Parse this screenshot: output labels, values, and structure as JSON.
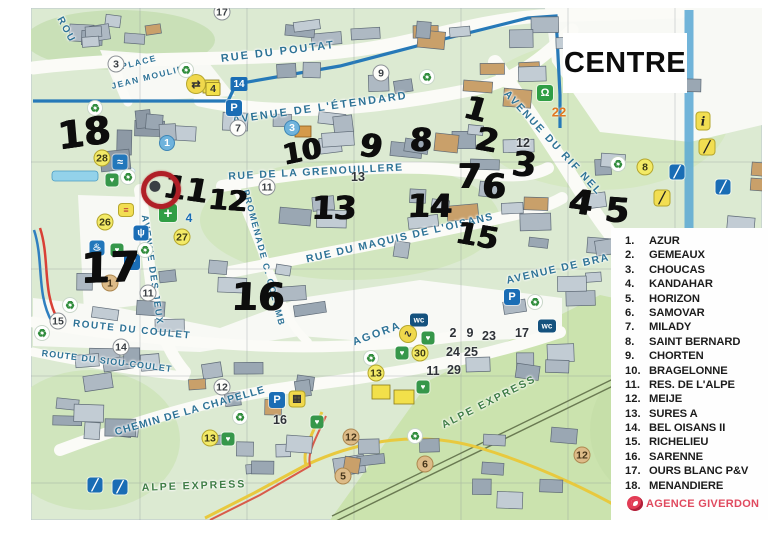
{
  "title": "CENTRE",
  "legend": {
    "agency": "AGENCE GIVERDON",
    "items": [
      {
        "num": "1.",
        "name": "AZUR"
      },
      {
        "num": "2.",
        "name": "GEMEAUX"
      },
      {
        "num": "3.",
        "name": "CHOUCAS"
      },
      {
        "num": "4.",
        "name": "KANDAHAR"
      },
      {
        "num": "5.",
        "name": "HORIZON"
      },
      {
        "num": "6.",
        "name": "SAMOVAR"
      },
      {
        "num": "7.",
        "name": "MILADY"
      },
      {
        "num": "8.",
        "name": "SAINT BERNARD"
      },
      {
        "num": "9.",
        "name": "CHORTEN"
      },
      {
        "num": "10.",
        "name": "BRAGELONNE"
      },
      {
        "num": "11.",
        "name": "RES. DE L'ALPE"
      },
      {
        "num": "12.",
        "name": "MEIJE"
      },
      {
        "num": "13.",
        "name": "SURES A"
      },
      {
        "num": "14.",
        "name": "BEL OISANS II"
      },
      {
        "num": "15.",
        "name": "RICHELIEU"
      },
      {
        "num": "16.",
        "name": "SARENNE"
      },
      {
        "num": "17.",
        "name": "OURS BLANC P&V"
      },
      {
        "num": "18.",
        "name": "MENANDIERE"
      }
    ]
  },
  "streets": [
    {
      "name": "ROU",
      "x": 66,
      "y": 30,
      "rot": 62,
      "size": 10,
      "ls": 2,
      "color": "teal"
    },
    {
      "name": "PLACE",
      "x": 139,
      "y": 62,
      "rot": -14,
      "size": 8.5,
      "ls": 1.5,
      "color": "teal"
    },
    {
      "name": "JEAN MOULIN",
      "x": 148,
      "y": 77,
      "rot": -14,
      "size": 8.5,
      "ls": 1.5,
      "color": "teal"
    },
    {
      "name": "RUE DU POUTAT",
      "x": 278,
      "y": 52,
      "rot": -7,
      "size": 11,
      "ls": 2,
      "color": "teal"
    },
    {
      "name": "AVENUE DE L'ÉTENDARD",
      "x": 320,
      "y": 108,
      "rot": -8,
      "size": 11,
      "ls": 2,
      "color": "teal"
    },
    {
      "name": "RUE DE LA GRENOUILLERE",
      "x": 316,
      "y": 172,
      "rot": -3,
      "size": 10.5,
      "ls": 1.5,
      "color": "teal"
    },
    {
      "name": "PROMENADE C. COLOMB",
      "x": 264,
      "y": 258,
      "rot": 75,
      "size": 9,
      "ls": 1.5,
      "color": "teal"
    },
    {
      "name": "RUE DU MAQUIS DE L'OISANS",
      "x": 400,
      "y": 238,
      "rot": -13,
      "size": 10.5,
      "ls": 1.5,
      "color": "teal"
    },
    {
      "name": "AVENUE DU RIF NEL",
      "x": 553,
      "y": 143,
      "rot": 47,
      "size": 10.5,
      "ls": 2,
      "color": "teal"
    },
    {
      "name": "AVENUE DE BRA",
      "x": 558,
      "y": 269,
      "rot": -13,
      "size": 10.5,
      "ls": 1.5,
      "color": "teal"
    },
    {
      "name": "AVENUE DES JEUX",
      "x": 152,
      "y": 270,
      "rot": 82,
      "size": 9.5,
      "ls": 1.5,
      "color": "teal"
    },
    {
      "name": "AGORA",
      "x": 377,
      "y": 334,
      "rot": -20,
      "size": 11,
      "ls": 2,
      "color": "teal"
    },
    {
      "name": "ROUTE DU COULET",
      "x": 132,
      "y": 330,
      "rot": 6,
      "size": 10,
      "ls": 1.5,
      "color": "teal"
    },
    {
      "name": "ROUTE DU SIOU-COULET",
      "x": 107,
      "y": 361,
      "rot": 7,
      "size": 9,
      "ls": 1,
      "color": "teal"
    },
    {
      "name": "CHEMIN DE LA CHAPELLE",
      "x": 190,
      "y": 411,
      "rot": -16,
      "size": 10.5,
      "ls": 1,
      "color": "teal"
    },
    {
      "name": "ALPE EXPRESS",
      "x": 489,
      "y": 402,
      "rot": -27,
      "size": 10.5,
      "ls": 2,
      "color": "green"
    },
    {
      "name": "ALPE EXPRESS",
      "x": 194,
      "y": 486,
      "rot": -2,
      "size": 10.5,
      "ls": 2,
      "color": "green"
    }
  ],
  "handwritten": [
    {
      "t": "18",
      "x": 84,
      "y": 133,
      "s": 38,
      "r": -8
    },
    {
      "t": "11",
      "x": 186,
      "y": 189,
      "s": 32,
      "r": 8
    },
    {
      "t": "12",
      "x": 228,
      "y": 201,
      "s": 28,
      "r": 4
    },
    {
      "t": "17",
      "x": 110,
      "y": 268,
      "s": 42,
      "r": -2
    },
    {
      "t": "16",
      "x": 258,
      "y": 297,
      "s": 38,
      "r": 0
    },
    {
      "t": "10",
      "x": 302,
      "y": 152,
      "s": 28,
      "r": -12
    },
    {
      "t": "9",
      "x": 371,
      "y": 146,
      "s": 32,
      "r": 8
    },
    {
      "t": "8",
      "x": 421,
      "y": 140,
      "s": 32,
      "r": 0
    },
    {
      "t": "13",
      "x": 334,
      "y": 208,
      "s": 32,
      "r": 0
    },
    {
      "t": "14",
      "x": 430,
      "y": 206,
      "s": 32,
      "r": 0
    },
    {
      "t": "15",
      "x": 477,
      "y": 237,
      "s": 30,
      "r": 10
    },
    {
      "t": "1",
      "x": 476,
      "y": 109,
      "s": 32,
      "r": 14
    },
    {
      "t": "2",
      "x": 487,
      "y": 140,
      "s": 32,
      "r": 10
    },
    {
      "t": "7",
      "x": 469,
      "y": 177,
      "s": 34,
      "r": 0
    },
    {
      "t": "6",
      "x": 494,
      "y": 187,
      "s": 34,
      "r": 0
    },
    {
      "t": "3",
      "x": 524,
      "y": 165,
      "s": 34,
      "r": 4
    },
    {
      "t": "4",
      "x": 581,
      "y": 203,
      "s": 34,
      "r": 8
    },
    {
      "t": "5",
      "x": 617,
      "y": 211,
      "s": 34,
      "r": 4
    }
  ],
  "markers": [
    {
      "t": "17",
      "x": 222,
      "y": 12,
      "k": "white"
    },
    {
      "t": "3",
      "x": 116,
      "y": 64,
      "k": "white"
    },
    {
      "t": "7",
      "x": 238,
      "y": 128,
      "k": "white"
    },
    {
      "t": "9",
      "x": 381,
      "y": 73,
      "k": "white"
    },
    {
      "t": "3",
      "x": 292,
      "y": 128,
      "k": "bluec"
    },
    {
      "t": "14",
      "x": 239,
      "y": 84,
      "k": "bluetag"
    },
    {
      "t": "4",
      "x": 213,
      "y": 89,
      "k": "yellowsq"
    },
    {
      "t": "22",
      "x": 559,
      "y": 112,
      "k": "orange"
    },
    {
      "t": "12",
      "x": 523,
      "y": 143,
      "k": "plain"
    },
    {
      "t": "13",
      "x": 358,
      "y": 177,
      "k": "plain"
    },
    {
      "t": "11",
      "x": 267,
      "y": 187,
      "k": "white"
    },
    {
      "t": "1",
      "x": 167,
      "y": 143,
      "k": "bluec"
    },
    {
      "t": "28",
      "x": 102,
      "y": 158,
      "k": "yellow"
    },
    {
      "t": "26",
      "x": 105,
      "y": 222,
      "k": "yellow"
    },
    {
      "t": "27",
      "x": 182,
      "y": 237,
      "k": "yellow"
    },
    {
      "t": "4",
      "x": 189,
      "y": 218,
      "k": "bluetext"
    },
    {
      "t": "8",
      "x": 645,
      "y": 167,
      "k": "yellow"
    },
    {
      "t": "11",
      "x": 148,
      "y": 293,
      "k": "white"
    },
    {
      "t": "1",
      "x": 110,
      "y": 283,
      "k": "tan"
    },
    {
      "t": "15",
      "x": 58,
      "y": 321,
      "k": "white"
    },
    {
      "t": "14",
      "x": 121,
      "y": 347,
      "k": "white"
    },
    {
      "t": "12",
      "x": 222,
      "y": 387,
      "k": "white"
    },
    {
      "t": "16",
      "x": 280,
      "y": 420,
      "k": "plain"
    },
    {
      "t": "13",
      "x": 210,
      "y": 438,
      "k": "yellow"
    },
    {
      "t": "2",
      "x": 453,
      "y": 333,
      "k": "plain"
    },
    {
      "t": "9",
      "x": 470,
      "y": 333,
      "k": "plain"
    },
    {
      "t": "23",
      "x": 489,
      "y": 336,
      "k": "plain"
    },
    {
      "t": "17",
      "x": 522,
      "y": 333,
      "k": "plain"
    },
    {
      "t": "30",
      "x": 420,
      "y": 353,
      "k": "yellow"
    },
    {
      "t": "24",
      "x": 453,
      "y": 352,
      "k": "plain"
    },
    {
      "t": "25",
      "x": 471,
      "y": 352,
      "k": "plain"
    },
    {
      "t": "11",
      "x": 433,
      "y": 371,
      "k": "plain"
    },
    {
      "t": "29",
      "x": 454,
      "y": 370,
      "k": "plain"
    },
    {
      "t": "13",
      "x": 376,
      "y": 373,
      "k": "yellow"
    },
    {
      "t": "12",
      "x": 351,
      "y": 437,
      "k": "tan"
    },
    {
      "t": "6",
      "x": 425,
      "y": 464,
      "k": "tan"
    },
    {
      "t": "12",
      "x": 582,
      "y": 455,
      "k": "tan"
    },
    {
      "t": "5",
      "x": 343,
      "y": 476,
      "k": "tan"
    }
  ],
  "icons": [
    {
      "k": "bus",
      "x": 196,
      "y": 84
    },
    {
      "k": "parking",
      "x": 234,
      "y": 108
    },
    {
      "k": "parking",
      "x": 132,
      "y": 262
    },
    {
      "k": "parking",
      "x": 512,
      "y": 297
    },
    {
      "k": "parking",
      "x": 277,
      "y": 400
    },
    {
      "k": "wc",
      "x": 419,
      "y": 320
    },
    {
      "k": "wc",
      "x": 547,
      "y": 326
    },
    {
      "k": "recycle",
      "x": 186,
      "y": 70
    },
    {
      "k": "recycle",
      "x": 95,
      "y": 108
    },
    {
      "k": "recycle",
      "x": 427,
      "y": 77
    },
    {
      "k": "recycle",
      "x": 618,
      "y": 164
    },
    {
      "k": "recycle",
      "x": 128,
      "y": 177
    },
    {
      "k": "recycle",
      "x": 145,
      "y": 250
    },
    {
      "k": "recycle",
      "x": 70,
      "y": 305
    },
    {
      "k": "recycle",
      "x": 42,
      "y": 333
    },
    {
      "k": "recycle",
      "x": 240,
      "y": 417
    },
    {
      "k": "recycle",
      "x": 535,
      "y": 302
    },
    {
      "k": "recycle",
      "x": 371,
      "y": 358
    },
    {
      "k": "recycle",
      "x": 415,
      "y": 436
    },
    {
      "k": "medical",
      "x": 545,
      "y": 93
    },
    {
      "k": "pharmacy",
      "x": 168,
      "y": 213
    },
    {
      "k": "plug",
      "x": 141,
      "y": 233
    },
    {
      "k": "pool",
      "x": 120,
      "y": 162
    },
    {
      "k": "sauna",
      "x": 97,
      "y": 248
    },
    {
      "k": "heart",
      "x": 112,
      "y": 180
    },
    {
      "k": "heart",
      "x": 117,
      "y": 250
    },
    {
      "k": "heart",
      "x": 428,
      "y": 338
    },
    {
      "k": "heart",
      "x": 402,
      "y": 353
    },
    {
      "k": "heart",
      "x": 423,
      "y": 387
    },
    {
      "k": "heart",
      "x": 228,
      "y": 439
    },
    {
      "k": "heart",
      "x": 317,
      "y": 422
    },
    {
      "k": "venue",
      "x": 408,
      "y": 334
    },
    {
      "k": "basket",
      "x": 297,
      "y": 399
    },
    {
      "k": "info",
      "x": 703,
      "y": 121
    },
    {
      "k": "skier",
      "x": 707,
      "y": 147
    },
    {
      "k": "skier",
      "x": 662,
      "y": 198
    },
    {
      "k": "lift",
      "x": 677,
      "y": 172
    },
    {
      "k": "lift",
      "x": 723,
      "y": 187
    },
    {
      "k": "lift",
      "x": 95,
      "y": 485
    },
    {
      "k": "lift",
      "x": 120,
      "y": 487
    },
    {
      "k": "sign",
      "x": 126,
      "y": 210
    }
  ],
  "annotation": {
    "red_circle": {
      "x": 161,
      "y": 190
    }
  },
  "colors": {
    "street_label": "#2e7396",
    "alpe_express_label": "#3f7d46",
    "handwritten_marker": "#0d0d0d",
    "red_annotation": "#b01f26",
    "agency_red": "#e04a5f",
    "parking_blue": "#1a6db5"
  }
}
